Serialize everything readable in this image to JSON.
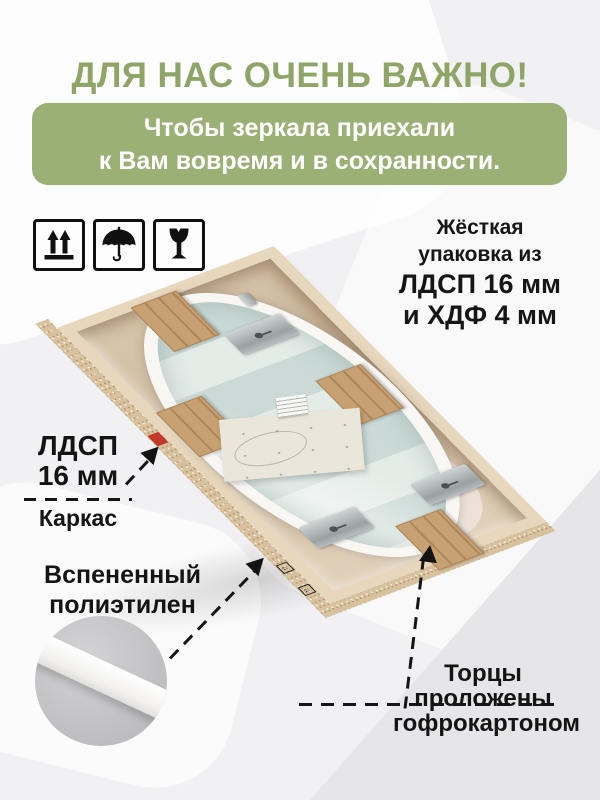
{
  "title": "ДЛЯ НАС ОЧЕНЬ ВАЖНО!",
  "subtitle": {
    "line1": "Чтобы зеркала приехали",
    "line2": "к Вам вовремя и в сохранности."
  },
  "handling_icons": [
    "this-way-up-icon",
    "keep-dry-icon",
    "fragile-icon"
  ],
  "packaging_note": {
    "line1": "Жёсткая",
    "line2": "упаковка из",
    "line3": "ЛДСП 16 мм",
    "line4": "и ХДФ 4 мм"
  },
  "callouts": {
    "frame": {
      "line1": "ЛДСП",
      "line2": "16 мм",
      "line3": "Каркас"
    },
    "foam": {
      "line1": "Вспененный",
      "line2": "полиэтилен"
    },
    "edges": {
      "line1": "Торцы",
      "line2": "проложены",
      "line3": "гофрокартоном"
    }
  },
  "colors": {
    "title_green": "#8fa567",
    "banner_green": "#9bb074",
    "text_black": "#141414",
    "chipboard": "#e7d7bd",
    "kraft_paper": "#cbb69a",
    "glass_band_dark": "#cbdad6",
    "glass_band_light": "#e4ece8",
    "foam_white": "#f8f7f4",
    "cardboard": "#c7a172"
  }
}
